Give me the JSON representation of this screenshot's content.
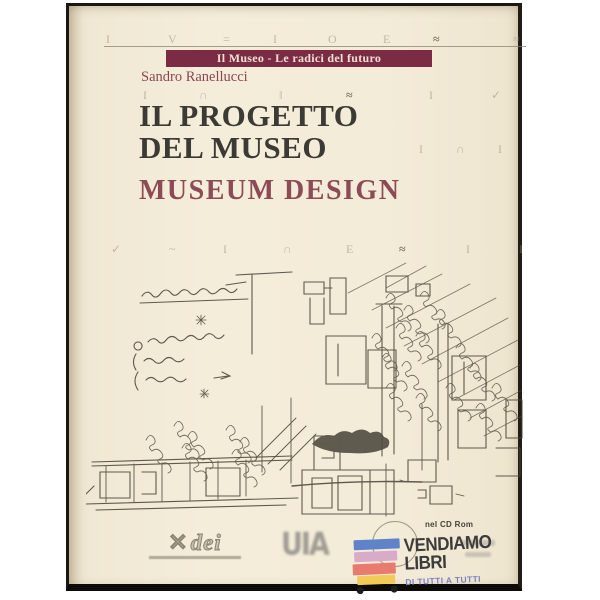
{
  "book": {
    "series_banner": "Il Museo - Le radici del futuro",
    "author": "Sandro Ranellucci",
    "title_line1": "IL PROGETTO",
    "title_line2": "DEL MUSEO",
    "subtitle": "MUSEUM DESIGN",
    "cd_note": "nel CD Rom",
    "colors": {
      "cover": "#f2ebd8",
      "banner": "#7c2b44",
      "banner_text": "#efe2d4",
      "author": "#8d4752",
      "title": "#3c3a34",
      "subtitle": "#8d4b55",
      "ink": "#4b4538"
    },
    "decor": {
      "row1": [
        "I",
        "V",
        "=",
        "I",
        "O",
        "E",
        "≈",
        "≈"
      ],
      "row2": [
        "I",
        "∩",
        "‖",
        "≈",
        "I",
        "✓"
      ],
      "row3": [
        "I",
        "∩",
        "I"
      ],
      "row4": [
        "✓",
        "~",
        "I",
        "∩",
        "E",
        "≈",
        "I",
        "I"
      ]
    }
  },
  "publishers": {
    "dei_mark": "✕",
    "dei_label": "dei",
    "uia_label": "UIA"
  },
  "store_watermark": {
    "line1": "VENDIAMO",
    "line2": "LIBRI",
    "tagline": "DI TUTTI A TUTTI",
    "bar_colors": [
      "#5f83c9",
      "#d9abc8",
      "#e97a70",
      "#f2ca58"
    ],
    "tagline_color": "#7f80c6"
  }
}
